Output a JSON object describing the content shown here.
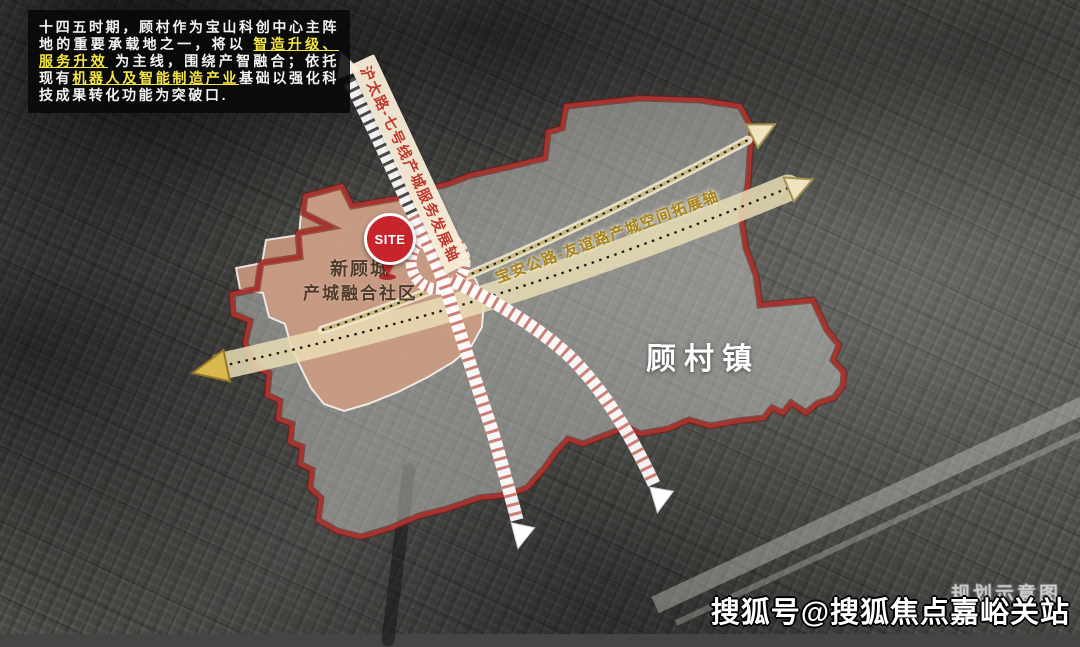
{
  "info_box": {
    "segments": [
      {
        "text": "十四五时期，顾村作为宝山科创中心主阵地的重要承载地之一，将以 "
      },
      {
        "text": "智造升级、服务升效"
      },
      {
        "text": " 为主线，围绕产智融合；依托现有"
      },
      {
        "text": "机器人及智能制造产业"
      },
      {
        "text": "基础以强化科技成果转化功能为突破口."
      }
    ]
  },
  "map": {
    "axis_labels": {
      "metro_axis": "沪太路-七号线产城服务发展轴",
      "corridor_axis": "宝安公路-友谊路产城空间拓展轴"
    },
    "site_marker_label": "SITE",
    "area_labels": {
      "new_gucheng_line1": "新顾城",
      "new_gucheng_line2": "产城融合社区",
      "gucun_town": "顾村镇"
    }
  },
  "watermarks": {
    "plan_note": "规划示意图",
    "sohu_account": "搜狐号@搜狐焦点嘉峪关站"
  },
  "colors": {
    "boundary_red": "#a8322c",
    "area_salmon": "#d19d83",
    "corridor_tan": "#e9ddb4",
    "highlight_yellow": "#f5e642",
    "site_red": "#c8242c"
  }
}
